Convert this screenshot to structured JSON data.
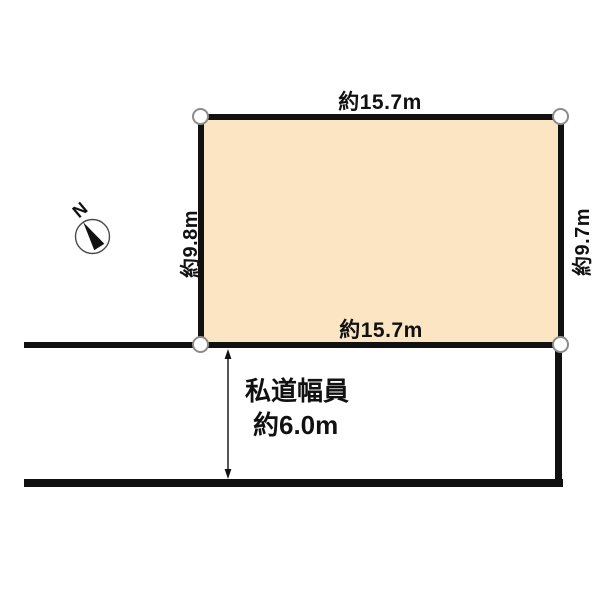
{
  "diagram": {
    "background_color": "#ffffff",
    "compass": {
      "label": "N"
    },
    "plot": {
      "fill_color": "#fbe5c2",
      "outline_color": "#111111",
      "top_edge_label": "約15.7m",
      "bottom_edge_label": "約15.7m",
      "left_edge_label": "約9.8m",
      "right_edge_label": "約9.7m"
    },
    "road": {
      "width_label_line1": "私道幅員",
      "width_label_line2": "約6.0m"
    },
    "corner_marker": {
      "fill_color": "#ffffff",
      "stroke_color": "#8c8c8c"
    }
  }
}
